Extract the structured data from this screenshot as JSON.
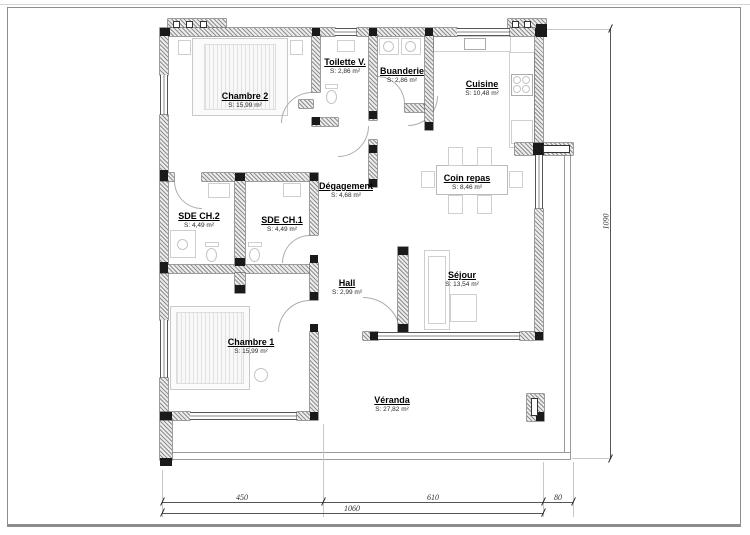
{
  "title": "Plan de maison - rez-de-chaussée",
  "rooms": [
    {
      "id": "chambre2",
      "name": "Chambre 2",
      "area": "S: 15,99 m²"
    },
    {
      "id": "toilette",
      "name": "Toilette V.",
      "area": "S: 2,86 m²"
    },
    {
      "id": "buanderie",
      "name": "Buanderie",
      "area": "S: 2,86 m²"
    },
    {
      "id": "cuisine",
      "name": "Cuisine",
      "area": "S: 10,48 m²"
    },
    {
      "id": "degagement",
      "name": "Dégagement",
      "area": "S: 4,68 m²"
    },
    {
      "id": "sde_ch2",
      "name": "SDE CH.2",
      "area": "S: 4,49 m²"
    },
    {
      "id": "sde_ch1",
      "name": "SDE CH.1",
      "area": "S: 4,49 m²"
    },
    {
      "id": "coin_repas",
      "name": "Coin repas",
      "area": "S: 8,46 m²"
    },
    {
      "id": "hall",
      "name": "Hall",
      "area": "S: 2,99 m²"
    },
    {
      "id": "sejour",
      "name": "Séjour",
      "area": "S: 13,54 m²"
    },
    {
      "id": "chambre1",
      "name": "Chambre 1",
      "area": "S: 15,99 m²"
    },
    {
      "id": "veranda",
      "name": "Véranda",
      "area": "S: 27,82 m²"
    }
  ],
  "dimensions": {
    "bottom": [
      "450",
      "610",
      "80"
    ],
    "bottom_total": "1060",
    "right_total": "1090"
  },
  "colors": {
    "wall_hatch": "#8f8f8f",
    "post": "#1a1a1a",
    "label_text": "#000000",
    "dim_text": "#333333",
    "frame": "#8d8d8d"
  }
}
